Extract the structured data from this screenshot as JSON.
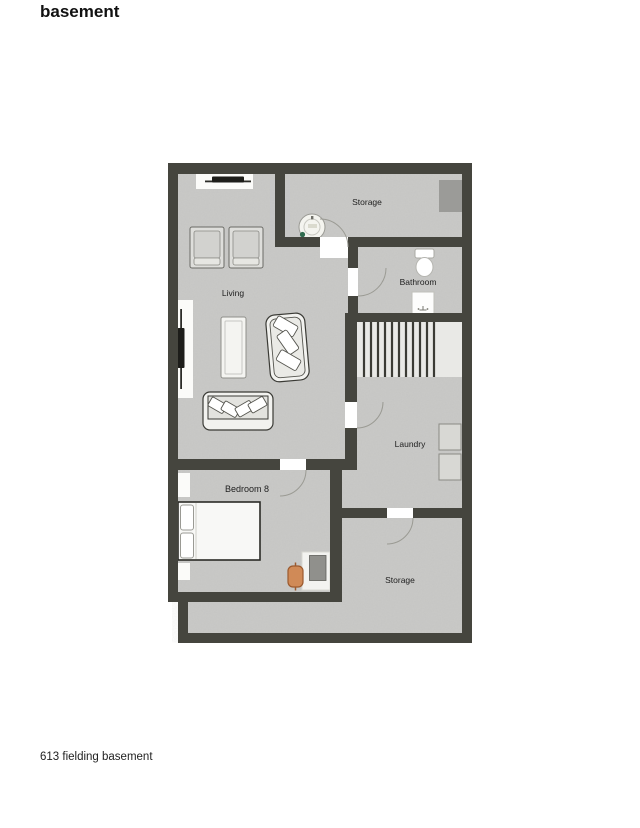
{
  "page": {
    "title": "basement",
    "caption": "613 fielding basement"
  },
  "floorplan": {
    "rooms": {
      "storage_top": {
        "label": "Storage"
      },
      "bathroom": {
        "label": "Bathroom"
      },
      "living": {
        "label": "Living"
      },
      "laundry": {
        "label": "Laundry"
      },
      "bedroom": {
        "label": "Bedroom 8"
      },
      "storage_bottom": {
        "label": "Storage"
      }
    },
    "colors": {
      "wall": "#45453e",
      "floor": "#c9c9c7",
      "background": "#ffffff",
      "stairs": "#e9e9e6",
      "chair_accent": "#d08a57",
      "water_heater_mark": "#2f6b4e"
    }
  }
}
